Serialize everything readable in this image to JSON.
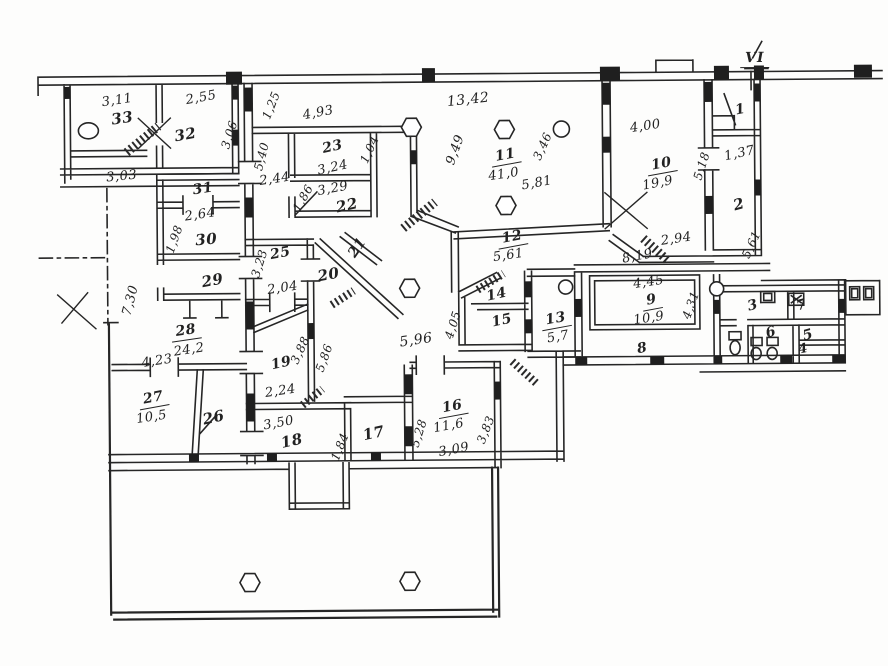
{
  "document": {
    "kind": "scanned floor plan",
    "sheet_mark": "VI"
  },
  "labels": [
    {
      "n": "dim-3-11",
      "t": "3,11",
      "x": 119,
      "y": 98,
      "r": -8,
      "s": 13,
      "k": "dim"
    },
    {
      "n": "room-33",
      "t": "33",
      "x": 124,
      "y": 116,
      "r": -8,
      "s": 15,
      "k": "room"
    },
    {
      "n": "dim-2-55",
      "t": "2,55",
      "x": 203,
      "y": 96,
      "r": -10,
      "s": 13,
      "k": "dim"
    },
    {
      "n": "room-32",
      "t": "32",
      "x": 187,
      "y": 133,
      "r": -10,
      "s": 15,
      "k": "room"
    },
    {
      "n": "dim-3-03",
      "t": "3,03",
      "x": 123,
      "y": 174,
      "r": -5,
      "s": 13,
      "k": "dim"
    },
    {
      "n": "dim-1-25",
      "t": "1,25",
      "x": 273,
      "y": 104,
      "r": -68,
      "s": 12,
      "k": "dim"
    },
    {
      "n": "dim-3-06",
      "t": "3,06",
      "x": 231,
      "y": 133,
      "r": -72,
      "s": 12,
      "k": "dim"
    },
    {
      "n": "dim-5-40",
      "t": "5,40",
      "x": 263,
      "y": 155,
      "r": -75,
      "s": 12,
      "k": "dim"
    },
    {
      "n": "dim-2-44",
      "t": "2,44",
      "x": 276,
      "y": 178,
      "r": -8,
      "s": 13,
      "k": "dim"
    },
    {
      "n": "room-31",
      "t": "31",
      "x": 204,
      "y": 187,
      "r": -8,
      "s": 14,
      "k": "room"
    },
    {
      "n": "dim-2-64",
      "t": "2,64",
      "x": 201,
      "y": 213,
      "r": -8,
      "s": 13,
      "k": "dim"
    },
    {
      "n": "room-30",
      "t": "30",
      "x": 207,
      "y": 238,
      "r": -5,
      "s": 15,
      "k": "room"
    },
    {
      "n": "dim-1-98",
      "t": "1,98",
      "x": 175,
      "y": 237,
      "r": -70,
      "s": 12,
      "k": "dim"
    },
    {
      "n": "room-29",
      "t": "29",
      "x": 213,
      "y": 279,
      "r": -10,
      "s": 15,
      "k": "room"
    },
    {
      "n": "dim-4-93",
      "t": "4,93",
      "x": 320,
      "y": 112,
      "r": -10,
      "s": 13,
      "k": "dim"
    },
    {
      "n": "room-23",
      "t": "23",
      "x": 334,
      "y": 146,
      "r": -12,
      "s": 14,
      "k": "room"
    },
    {
      "n": "dim-3-24",
      "t": "3,24",
      "x": 334,
      "y": 167,
      "r": -12,
      "s": 13,
      "k": "dim"
    },
    {
      "n": "dim-1-04",
      "t": "1,04",
      "x": 371,
      "y": 149,
      "r": -65,
      "s": 12,
      "k": "dim"
    },
    {
      "n": "dim-3-29",
      "t": "3,29",
      "x": 334,
      "y": 188,
      "r": -10,
      "s": 13,
      "k": "dim"
    },
    {
      "n": "room-22",
      "t": "22",
      "x": 348,
      "y": 205,
      "r": -12,
      "s": 15,
      "k": "room"
    },
    {
      "n": "dim-1-86",
      "t": "1,86",
      "x": 304,
      "y": 197,
      "r": -60,
      "s": 12,
      "k": "dim"
    },
    {
      "n": "dim-13-42",
      "t": "13,42",
      "x": 470,
      "y": 100,
      "r": -6,
      "s": 14,
      "k": "dim"
    },
    {
      "n": "dim-9-49",
      "t": "9,49",
      "x": 457,
      "y": 150,
      "r": -70,
      "s": 13,
      "k": "dim"
    },
    {
      "n": "room-11",
      "t": "11",
      "x": 507,
      "y": 157,
      "r": -10,
      "s": 14,
      "k": "room",
      "u": true
    },
    {
      "n": "dim-41-0",
      "t": "41,0",
      "x": 505,
      "y": 175,
      "r": -8,
      "s": 13,
      "k": "dim"
    },
    {
      "n": "dim-5-81",
      "t": "5,81",
      "x": 538,
      "y": 184,
      "r": -10,
      "s": 13,
      "k": "dim"
    },
    {
      "n": "dim-3-46",
      "t": "3,46",
      "x": 544,
      "y": 147,
      "r": -65,
      "s": 12,
      "k": "dim"
    },
    {
      "n": "dim-4-00",
      "t": "4,00",
      "x": 647,
      "y": 128,
      "r": -8,
      "s": 13,
      "k": "dim"
    },
    {
      "n": "room-10",
      "t": "10",
      "x": 663,
      "y": 167,
      "r": -10,
      "s": 14,
      "k": "room",
      "u": true
    },
    {
      "n": "dim-19-9",
      "t": "19,9",
      "x": 659,
      "y": 185,
      "r": -10,
      "s": 13,
      "k": "dim"
    },
    {
      "n": "dim-5-18",
      "t": "5,18",
      "x": 703,
      "y": 168,
      "r": -72,
      "s": 12,
      "k": "dim"
    },
    {
      "n": "mark-vi",
      "t": "VI",
      "x": 757,
      "y": 62,
      "r": 0,
      "s": 14,
      "k": "mark",
      "u": true
    },
    {
      "n": "room-1",
      "t": "1",
      "x": 742,
      "y": 112,
      "r": -10,
      "s": 14,
      "k": "room"
    },
    {
      "n": "dim-1-37",
      "t": "1,37",
      "x": 741,
      "y": 156,
      "r": -12,
      "s": 13,
      "k": "dim"
    },
    {
      "n": "room-2",
      "t": "2",
      "x": 740,
      "y": 207,
      "r": -15,
      "s": 15,
      "k": "room"
    },
    {
      "n": "dim-5-61-b",
      "t": "5,61",
      "x": 752,
      "y": 247,
      "r": -65,
      "s": 12,
      "k": "dim"
    },
    {
      "n": "dim-2-94",
      "t": "2,94",
      "x": 677,
      "y": 241,
      "r": -8,
      "s": 13,
      "k": "dim"
    },
    {
      "n": "dim-8-19",
      "t": "8,19",
      "x": 638,
      "y": 258,
      "r": -10,
      "s": 13,
      "k": "dim"
    },
    {
      "n": "room-12",
      "t": "12",
      "x": 513,
      "y": 239,
      "r": -10,
      "s": 14,
      "k": "room",
      "u": true
    },
    {
      "n": "dim-5-61-a",
      "t": "5,61",
      "x": 509,
      "y": 256,
      "r": -8,
      "s": 13,
      "k": "dim"
    },
    {
      "n": "room-14",
      "t": "14",
      "x": 497,
      "y": 295,
      "r": -12,
      "s": 14,
      "k": "room"
    },
    {
      "n": "room-15",
      "t": "15",
      "x": 502,
      "y": 321,
      "r": -12,
      "s": 14,
      "k": "room"
    },
    {
      "n": "room-13",
      "t": "13",
      "x": 556,
      "y": 321,
      "r": -10,
      "s": 14,
      "k": "room",
      "u": true
    },
    {
      "n": "dim-5-7",
      "t": "5,7",
      "x": 558,
      "y": 338,
      "r": -10,
      "s": 13,
      "k": "dim"
    },
    {
      "n": "dim-4-05",
      "t": "4,05",
      "x": 453,
      "y": 325,
      "r": -72,
      "s": 12,
      "k": "dim"
    },
    {
      "n": "dim-4-45",
      "t": "4,45",
      "x": 649,
      "y": 284,
      "r": -8,
      "s": 13,
      "k": "dim"
    },
    {
      "n": "room-9",
      "t": "9",
      "x": 652,
      "y": 303,
      "r": -10,
      "s": 14,
      "k": "room",
      "u": true
    },
    {
      "n": "dim-10-9",
      "t": "10,9",
      "x": 649,
      "y": 320,
      "r": -8,
      "s": 13,
      "k": "dim"
    },
    {
      "n": "dim-4-31",
      "t": "4,31",
      "x": 691,
      "y": 307,
      "r": -70,
      "s": 12,
      "k": "dim"
    },
    {
      "n": "room-8",
      "t": "8",
      "x": 642,
      "y": 350,
      "r": -10,
      "s": 14,
      "k": "room"
    },
    {
      "n": "room-3",
      "t": "3",
      "x": 753,
      "y": 308,
      "r": -15,
      "s": 14,
      "k": "room"
    },
    {
      "n": "room-7",
      "t": "7",
      "x": 802,
      "y": 308,
      "r": -15,
      "s": 14,
      "k": "room"
    },
    {
      "n": "room-6",
      "t": "6",
      "x": 771,
      "y": 335,
      "r": -15,
      "s": 14,
      "k": "room"
    },
    {
      "n": "room-5",
      "t": "5",
      "x": 808,
      "y": 338,
      "r": -15,
      "s": 14,
      "k": "room"
    },
    {
      "n": "room-4",
      "t": "4",
      "x": 803,
      "y": 352,
      "r": -10,
      "s": 13,
      "k": "room"
    },
    {
      "n": "room-25",
      "t": "25",
      "x": 281,
      "y": 252,
      "r": -10,
      "s": 14,
      "k": "room"
    },
    {
      "n": "dim-2-04",
      "t": "2,04",
      "x": 283,
      "y": 287,
      "r": -8,
      "s": 13,
      "k": "dim"
    },
    {
      "n": "dim-3-23",
      "t": "3,23",
      "x": 260,
      "y": 262,
      "r": -72,
      "s": 12,
      "k": "dim"
    },
    {
      "n": "room-20",
      "t": "20",
      "x": 329,
      "y": 274,
      "r": -10,
      "s": 15,
      "k": "room"
    },
    {
      "n": "room-21",
      "t": "21",
      "x": 358,
      "y": 247,
      "r": -55,
      "s": 14,
      "k": "room"
    },
    {
      "n": "dim-5-96",
      "t": "5,96",
      "x": 416,
      "y": 340,
      "r": -8,
      "s": 14,
      "k": "dim"
    },
    {
      "n": "dim-7-30",
      "t": "7,30",
      "x": 131,
      "y": 298,
      "r": -75,
      "s": 13,
      "k": "dim"
    },
    {
      "n": "room-28",
      "t": "28",
      "x": 186,
      "y": 330,
      "r": -8,
      "s": 14,
      "k": "room",
      "u": true
    },
    {
      "n": "dim-24-2",
      "t": "24,2",
      "x": 189,
      "y": 348,
      "r": -8,
      "s": 13,
      "k": "dim"
    },
    {
      "n": "dim-4-23",
      "t": "4,23",
      "x": 157,
      "y": 359,
      "r": -8,
      "s": 13,
      "k": "dim"
    },
    {
      "n": "room-19",
      "t": "19",
      "x": 281,
      "y": 362,
      "r": -12,
      "s": 14,
      "k": "room"
    },
    {
      "n": "dim-3-88",
      "t": "3,88",
      "x": 300,
      "y": 349,
      "r": -65,
      "s": 12,
      "k": "dim"
    },
    {
      "n": "dim-5-86",
      "t": "5,86",
      "x": 324,
      "y": 357,
      "r": -70,
      "s": 12,
      "k": "dim"
    },
    {
      "n": "dim-2-24",
      "t": "2,24",
      "x": 280,
      "y": 390,
      "r": -8,
      "s": 13,
      "k": "dim"
    },
    {
      "n": "room-27",
      "t": "27",
      "x": 153,
      "y": 397,
      "r": -10,
      "s": 14,
      "k": "room",
      "u": true
    },
    {
      "n": "dim-10-5",
      "t": "10,5",
      "x": 151,
      "y": 415,
      "r": -8,
      "s": 13,
      "k": "dim"
    },
    {
      "n": "room-26",
      "t": "26",
      "x": 213,
      "y": 416,
      "r": -12,
      "s": 15,
      "k": "room"
    },
    {
      "n": "dim-3-50",
      "t": "3,50",
      "x": 278,
      "y": 422,
      "r": -10,
      "s": 13,
      "k": "dim"
    },
    {
      "n": "room-18",
      "t": "18",
      "x": 291,
      "y": 440,
      "r": -12,
      "s": 15,
      "k": "room"
    },
    {
      "n": "dim-1-84",
      "t": "1,84",
      "x": 339,
      "y": 446,
      "r": -68,
      "s": 12,
      "k": "dim"
    },
    {
      "n": "room-17",
      "t": "17",
      "x": 373,
      "y": 433,
      "r": -12,
      "s": 15,
      "k": "room"
    },
    {
      "n": "dim-5-28",
      "t": "5,28",
      "x": 418,
      "y": 433,
      "r": -72,
      "s": 12,
      "k": "dim"
    },
    {
      "n": "room-16",
      "t": "16",
      "x": 452,
      "y": 408,
      "r": -10,
      "s": 14,
      "k": "room",
      "u": true
    },
    {
      "n": "dim-11-6",
      "t": "11,6",
      "x": 448,
      "y": 426,
      "r": -10,
      "s": 13,
      "k": "dim"
    },
    {
      "n": "dim-3-09",
      "t": "3,09",
      "x": 453,
      "y": 450,
      "r": -10,
      "s": 13,
      "k": "dim"
    },
    {
      "n": "dim-3-83",
      "t": "3,83",
      "x": 485,
      "y": 430,
      "r": -68,
      "s": 12,
      "k": "dim"
    }
  ]
}
